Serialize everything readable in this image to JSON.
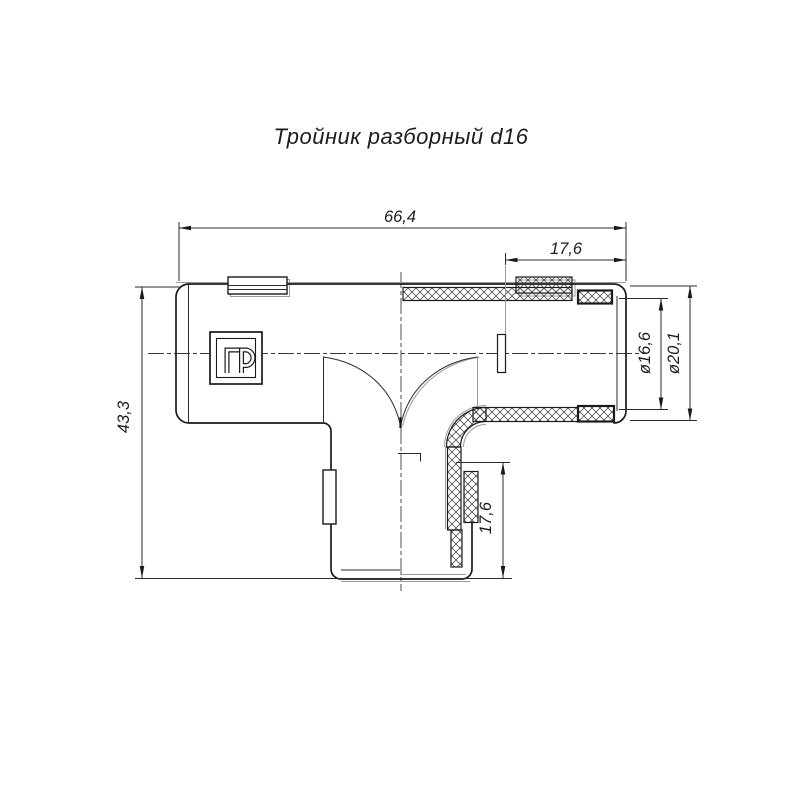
{
  "title": "Тройник разборный d16",
  "drawing": {
    "type": "technical-drawing",
    "part_name": "Тройник разборный d16",
    "logo_text": "ПР",
    "units": "mm",
    "dimensions": {
      "total_width": "66,4",
      "branch_engagement_right": "17,6",
      "total_height": "43,3",
      "inner_diameter": "ø16,6",
      "outer_diameter": "ø20,1",
      "branch_engagement_bottom": "17,6"
    }
  },
  "colors": {
    "background": "#ffffff",
    "line_main": "#1a1a1a",
    "line_secondary": "#9a9a9a",
    "text": "#1c1c1c"
  }
}
